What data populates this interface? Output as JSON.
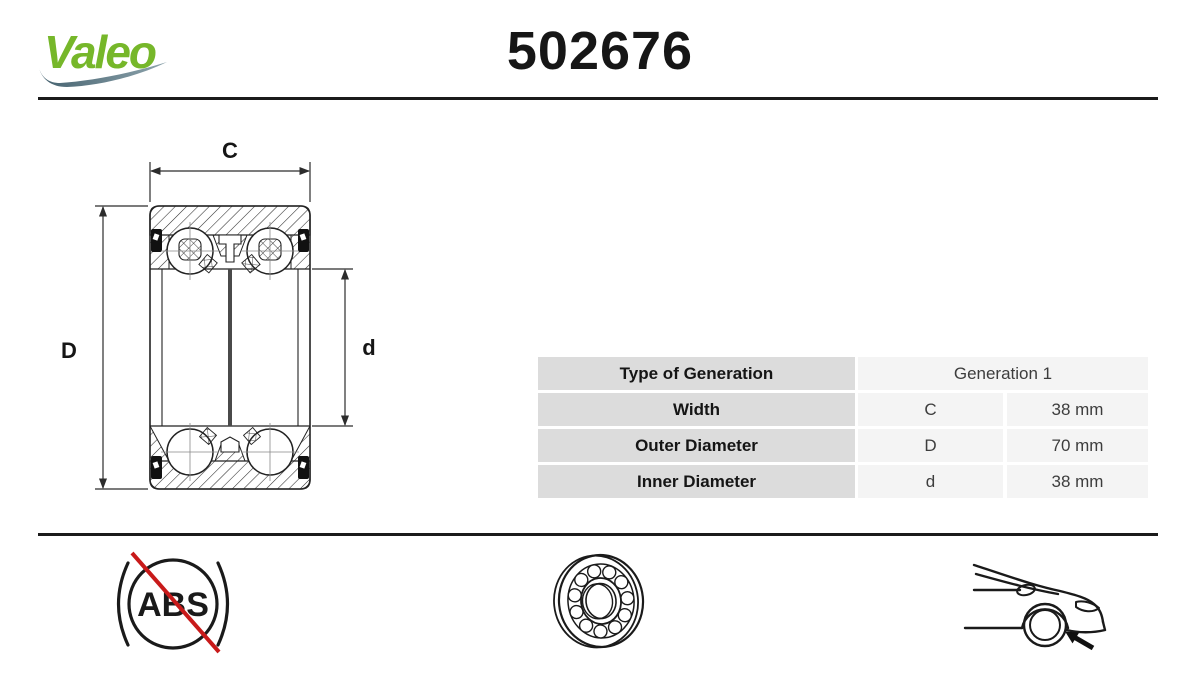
{
  "header": {
    "brand": "Valeo",
    "part_number": "502676"
  },
  "colors": {
    "brand_green": "#76b72a",
    "swoosh_dark": "#44616e",
    "swoosh_light": "#8ea4ad",
    "rule": "#1b1b1b",
    "table_label_bg": "#dcdcdc",
    "table_value_bg": "#f4f4f4",
    "strike_red": "#c81a1a",
    "line_black": "#1a1a1a"
  },
  "drawing": {
    "dim_width": "C",
    "dim_outer": "D",
    "dim_inner": "d"
  },
  "spec_table": {
    "rows": [
      {
        "label": "Type of Generation",
        "value": "Generation 1"
      },
      {
        "label": "Width",
        "symbol": "C",
        "value": "38 mm"
      },
      {
        "label": "Outer Diameter",
        "symbol": "D",
        "value": "70 mm"
      },
      {
        "label": "Inner Diameter",
        "symbol": "d",
        "value": "38 mm"
      }
    ]
  },
  "footer": {
    "abs_label": "ABS"
  }
}
